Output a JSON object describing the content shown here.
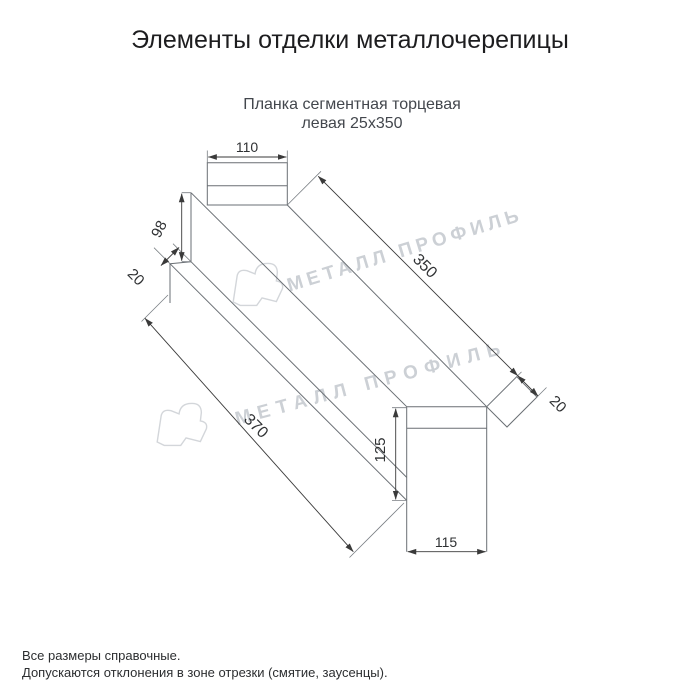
{
  "page": {
    "title": "Элементы отделки металлочерепицы",
    "subtitle_line1": "Планка сегментная торцевая",
    "subtitle_line2": "левая 25x350"
  },
  "drawing": {
    "type": "technical-outline-drawing",
    "dims": {
      "top_width": "110",
      "flange_height": "98",
      "hem_width": "20",
      "length_top": "350",
      "end_tab": "20",
      "length_bottom": "370",
      "end_height": "125",
      "end_width": "115"
    }
  },
  "watermark": {
    "text": "МЕТАЛЛ ПРОФИЛЬ"
  },
  "footer": {
    "line1": "Все размеры справочные.",
    "line2": "Допускаются отклонения в зоне отрезки (смятие, заусенцы)."
  },
  "colors": {
    "line": "#6a6f74",
    "dimension": "#3a3a3a",
    "watermark": "#ccd0d5",
    "title": "#1d1d1f",
    "subtitle": "#43474d",
    "background": "#ffffff"
  }
}
